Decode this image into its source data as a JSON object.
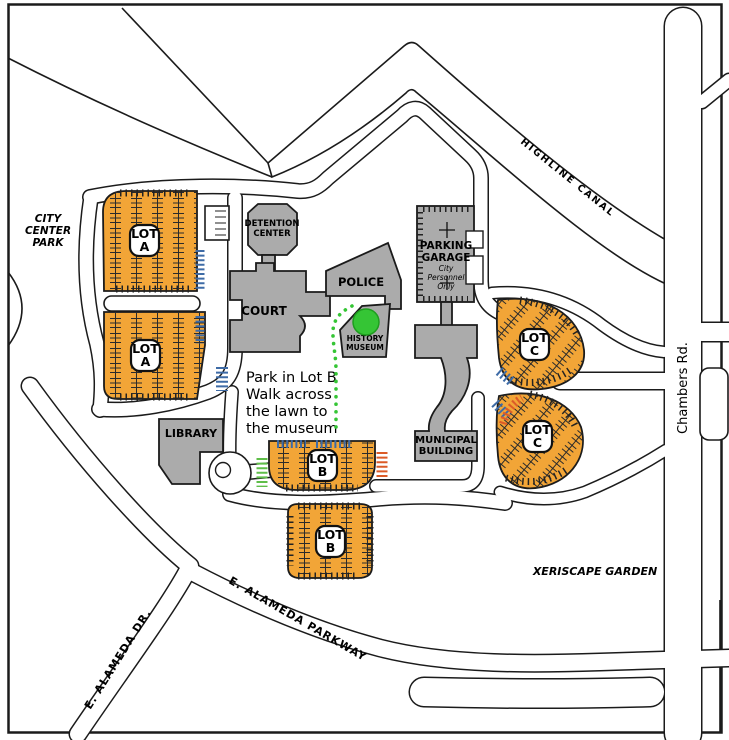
{
  "map": {
    "labels": {
      "city_park": [
        "CITY",
        "CENTER",
        "PARK"
      ],
      "highline": "HIGHLINE CANAL",
      "chambers": "Chambers Rd.",
      "pkwy": "E. ALAMEDA PARKWAY",
      "dr": "E. ALAMEDA DR.",
      "xeriscape": "XERISCAPE GARDEN",
      "detention": [
        "DETENTION",
        "CENTER"
      ],
      "court": "COURT",
      "police": "POLICE",
      "museum": [
        "HISTORY",
        "MUSEUM"
      ],
      "garage": [
        "PARKING",
        "GARAGE"
      ],
      "garage_note": [
        "City",
        "Personnel",
        "Only"
      ],
      "municipal": [
        "MUNICIPAL",
        "BUILDING"
      ],
      "library": "LIBRARY",
      "lot_a": [
        "LOT",
        "A"
      ],
      "lot_b": [
        "LOT",
        "B"
      ],
      "lot_c": [
        "LOT",
        "C"
      ],
      "note": [
        "Park in Lot B",
        "Walk across",
        "the lawn to",
        "the museum"
      ]
    },
    "colors": {
      "lot_fill": "#F2A537",
      "building_fill": "#ABABAB",
      "stripe_blue": "#3E6BA6",
      "stripe_green": "#5FBE49",
      "stripe_red": "#DC5B28",
      "marker_green": "#35C535",
      "marker_edge": "#1f9e1f"
    }
  }
}
